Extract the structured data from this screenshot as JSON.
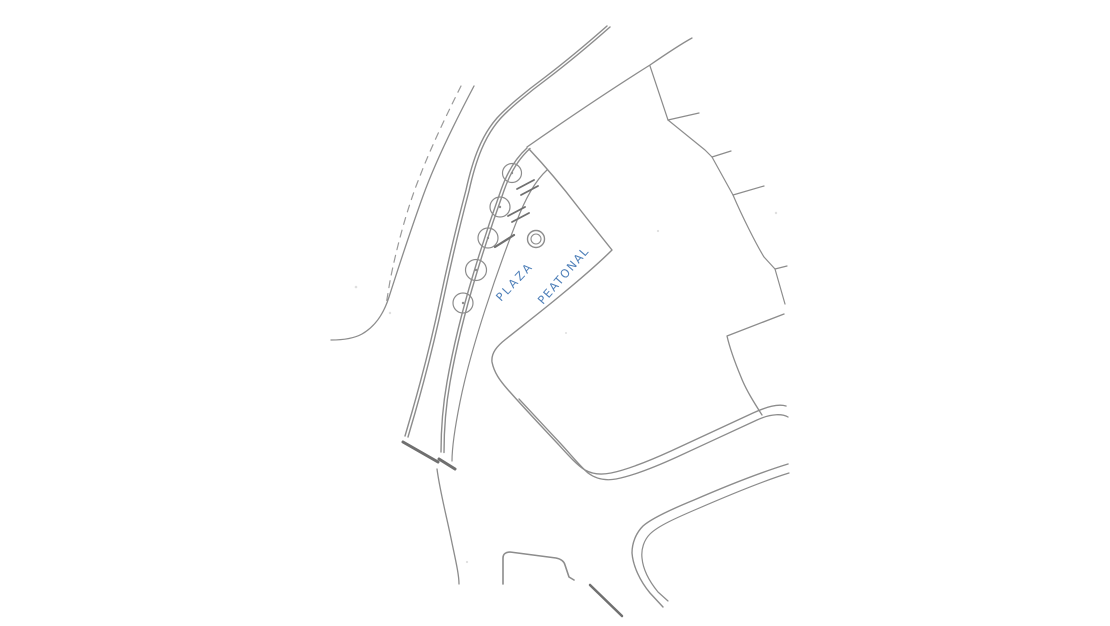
{
  "drawing": {
    "kind": "hand-drawn pedestrian plaza site plan sketch",
    "label": {
      "line1": "PLAZA",
      "line2": "PEATONAL",
      "color": "#4e7fb8",
      "rotation_deg": -47
    },
    "ink_color": "#8c8c8c",
    "background_color": "#ffffff",
    "tree_count": 5,
    "bench_count": 3,
    "fountain_count": 1,
    "features": [
      "dashed-boundary-line",
      "curved-street-double-curbs",
      "tree-row",
      "plaza-area",
      "fountain-double-circle",
      "bench-dashes",
      "building-stepped-edge",
      "street-corner-curves",
      "bottom-intersection"
    ]
  }
}
